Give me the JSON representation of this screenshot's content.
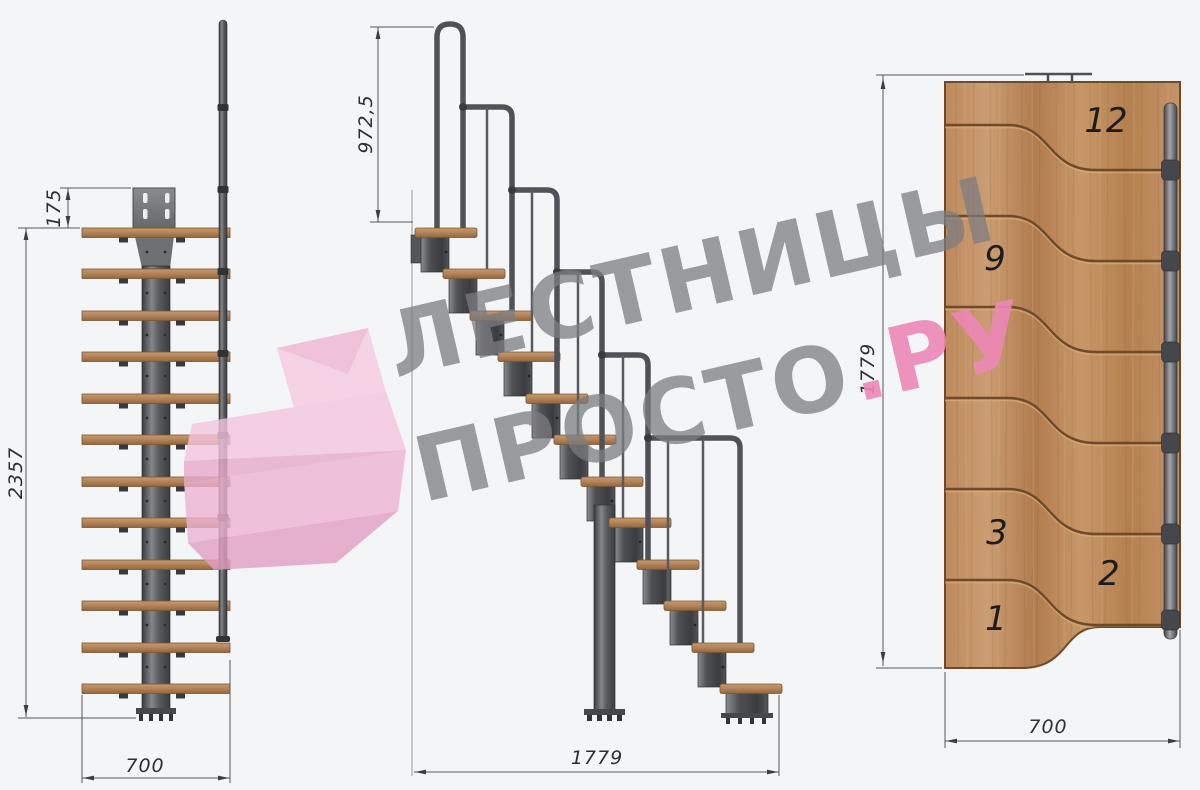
{
  "watermark": {
    "line1": "ЛЕСТНИЦЫ",
    "line2_gray": "ПРОСТО",
    "line2_pink": ".РУ"
  },
  "front_view": {
    "dim_plate_offset": "175",
    "dim_total_height": "2357",
    "dim_width": "700"
  },
  "side_view": {
    "dim_handrail_height": "972,5",
    "dim_total_run": "1779"
  },
  "plan_view": {
    "dim_total_length": "1779",
    "dim_width": "700",
    "step_labels": [
      "12",
      "9",
      "3",
      "2",
      "1"
    ]
  },
  "colors": {
    "background": "#f4f5f7",
    "wood": "#b5855c",
    "wood_outline": "#6e4a29",
    "steel": "#55565a",
    "dimension_line": "#4a4b4e",
    "watermark_gray": "#8f8f92",
    "watermark_pink": "#ec8cb8",
    "logo_pink": "#f2bcd8"
  }
}
